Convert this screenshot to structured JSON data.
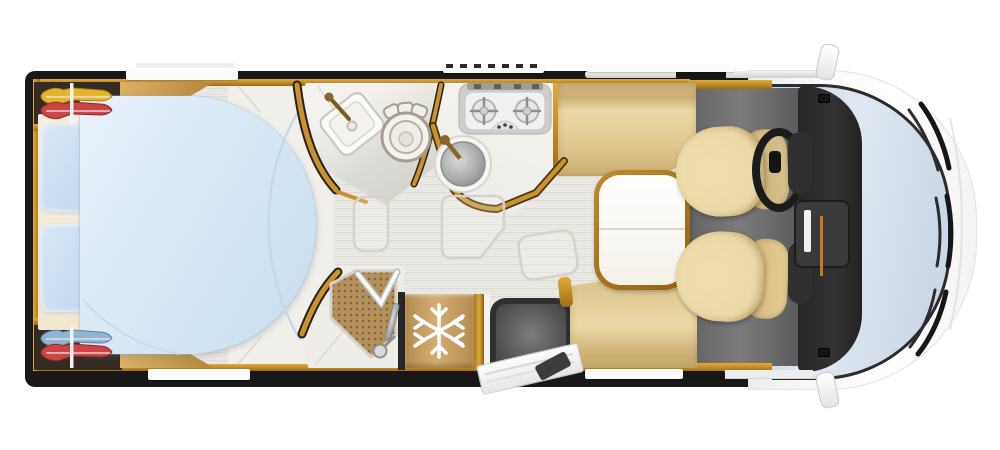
{
  "meta": {
    "title": "Motorhome floor plan — overhead view",
    "image_type": "illustrated top-view layout, no visible text"
  },
  "colors": {
    "bg": "#ffffff",
    "shell": "#181818",
    "wood": "#a87c2c",
    "floor-light": "#e9e7e1",
    "floor-white": "#f1efe9",
    "cab-floor": "#7b7b7b",
    "seat-beige": "#ecd9a8",
    "duvet-blue": "#d4e6f5",
    "pillow-blue": "#c2d8ee",
    "mattress-cream": "#f6efdf",
    "table-top": "#ffffff",
    "fridge-tan": "#d3ad72",
    "shower-tile": "#b3905c",
    "mat-grey": "#555555",
    "dash-dark": "#333333",
    "windshield": "#dfe8f2",
    "window-white": "#fcfcfc",
    "cloth-yellow": "#e3b52c",
    "cloth-red": "#cc4444",
    "cloth-blue": "#8fb4d4",
    "gold-trim": "#c89232"
  },
  "icons": {
    "snowflake": "refrigerator-freezer marker on fridge door",
    "hanging-clothes": "garments on rails inside rear wardrobes",
    "burner-cross": "pan supports on 2-burner gas hob"
  },
  "regions": {
    "bedroom": [
      "wardrobe-rear-top",
      "wardrobe-rear-bottom",
      "island-bed",
      "duvet",
      "pillow-1",
      "pillow-2",
      "overhead-cabinet-top",
      "overhead-cabinet-bottom"
    ],
    "bathroom": [
      "corner-washbasin",
      "basin-faucet",
      "toilet"
    ],
    "shower": [
      "tiled-shower-tray",
      "folding-glass-door",
      "shower-column",
      "hand-shower"
    ],
    "kitchen": [
      "worktop",
      "two-burner-cooktop",
      "round-sink",
      "sink-faucet"
    ],
    "appliances": [
      "refrigerator"
    ],
    "entry": [
      "door-mat",
      "entry-door-open",
      "entry-step"
    ],
    "dinette": [
      "bench-seat-rear",
      "bench-seat-front",
      "pedestal-table"
    ],
    "cab": [
      "driver-swivel-seat",
      "passenger-swivel-seat",
      "steering-wheel",
      "dashboard",
      "windshield",
      "wiper-blades",
      "wing-mirror-top",
      "wing-mirror-bottom"
    ]
  }
}
